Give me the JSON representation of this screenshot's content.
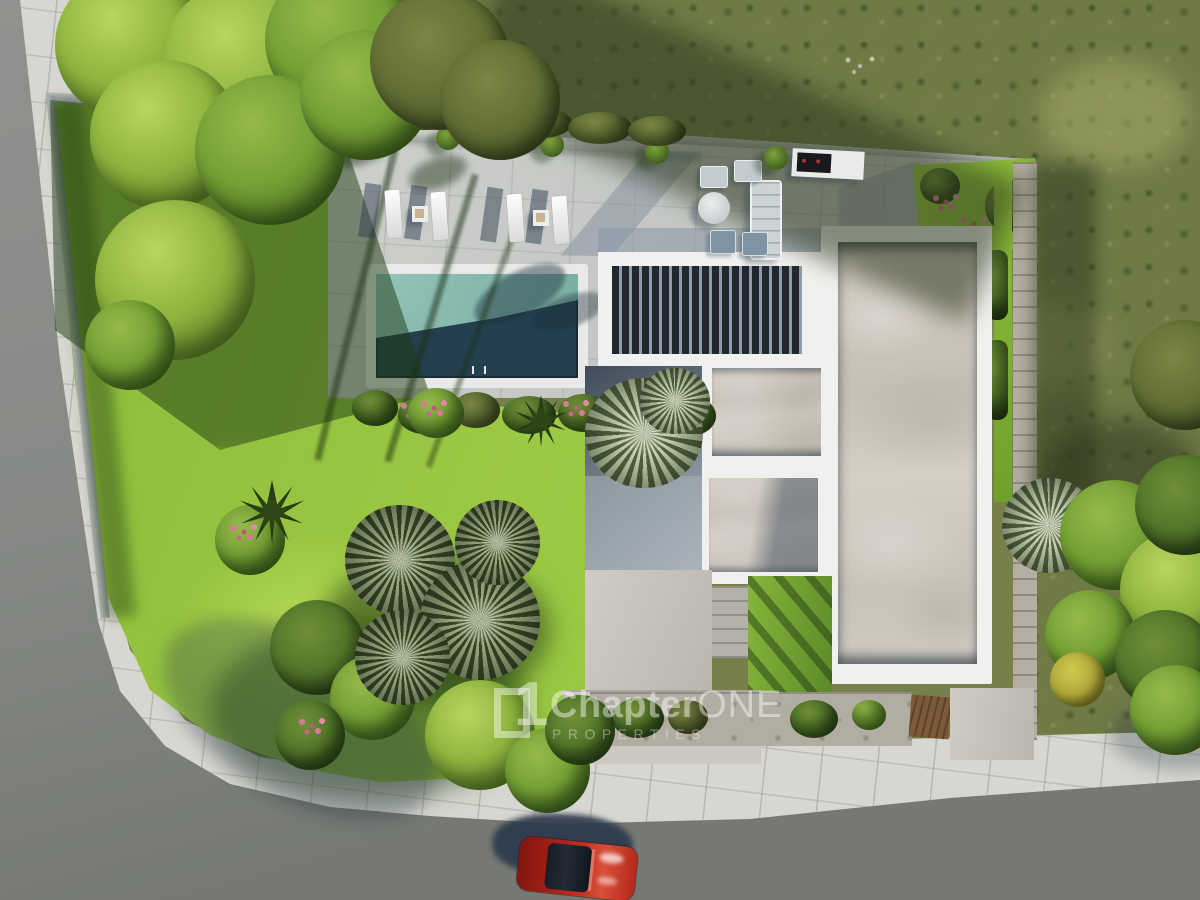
{
  "scene": {
    "type": "aerial-3d-architectural-render",
    "subject": "modern villa plot, top-down view",
    "elements": [
      "flat-roof-villa",
      "swimming-pool",
      "pool-terrace",
      "sun-loungers",
      "outdoor-lounge-set",
      "bbq-counter",
      "slatted-pergola",
      "lawn",
      "palm-trees",
      "trees",
      "flower-beds",
      "boundary-wall",
      "driveway",
      "garden-gate",
      "sidewalk",
      "road",
      "parked-red-car",
      "scrubland"
    ]
  },
  "watermark": {
    "logo_glyph": "1",
    "brand": "Chapter",
    "brand_accent": "ONE",
    "subtitle": "PROPERTIES"
  },
  "colors": {
    "asphalt": "#858883",
    "sidewalk": "#d7d6d0",
    "lawn": "#96c23f",
    "lawn_shadow": "#3f6120",
    "scrub": "#6f7a45",
    "terrace": "#c7c9c6",
    "terrace_shadow": "#8c99a6",
    "pool_teal": "#84b7ad",
    "pool_deep": "#24404f",
    "roof_white": "#f0f1ee",
    "roof_concrete": "#cbc4ba",
    "pergola_slat": "#22272c",
    "tree_green": "#7da23a",
    "palm_gray": "#93a177",
    "flower_pink": "#d87a96",
    "gravel": "#b5afa3",
    "wood_brown": "#7a5a3b",
    "car_red": "#b2251a",
    "shadow_navy": "#2c3a4c",
    "watermark_white": "rgba(255,255,255,0.45)",
    "watermark_dim": "rgba(255,255,255,0.38)"
  }
}
